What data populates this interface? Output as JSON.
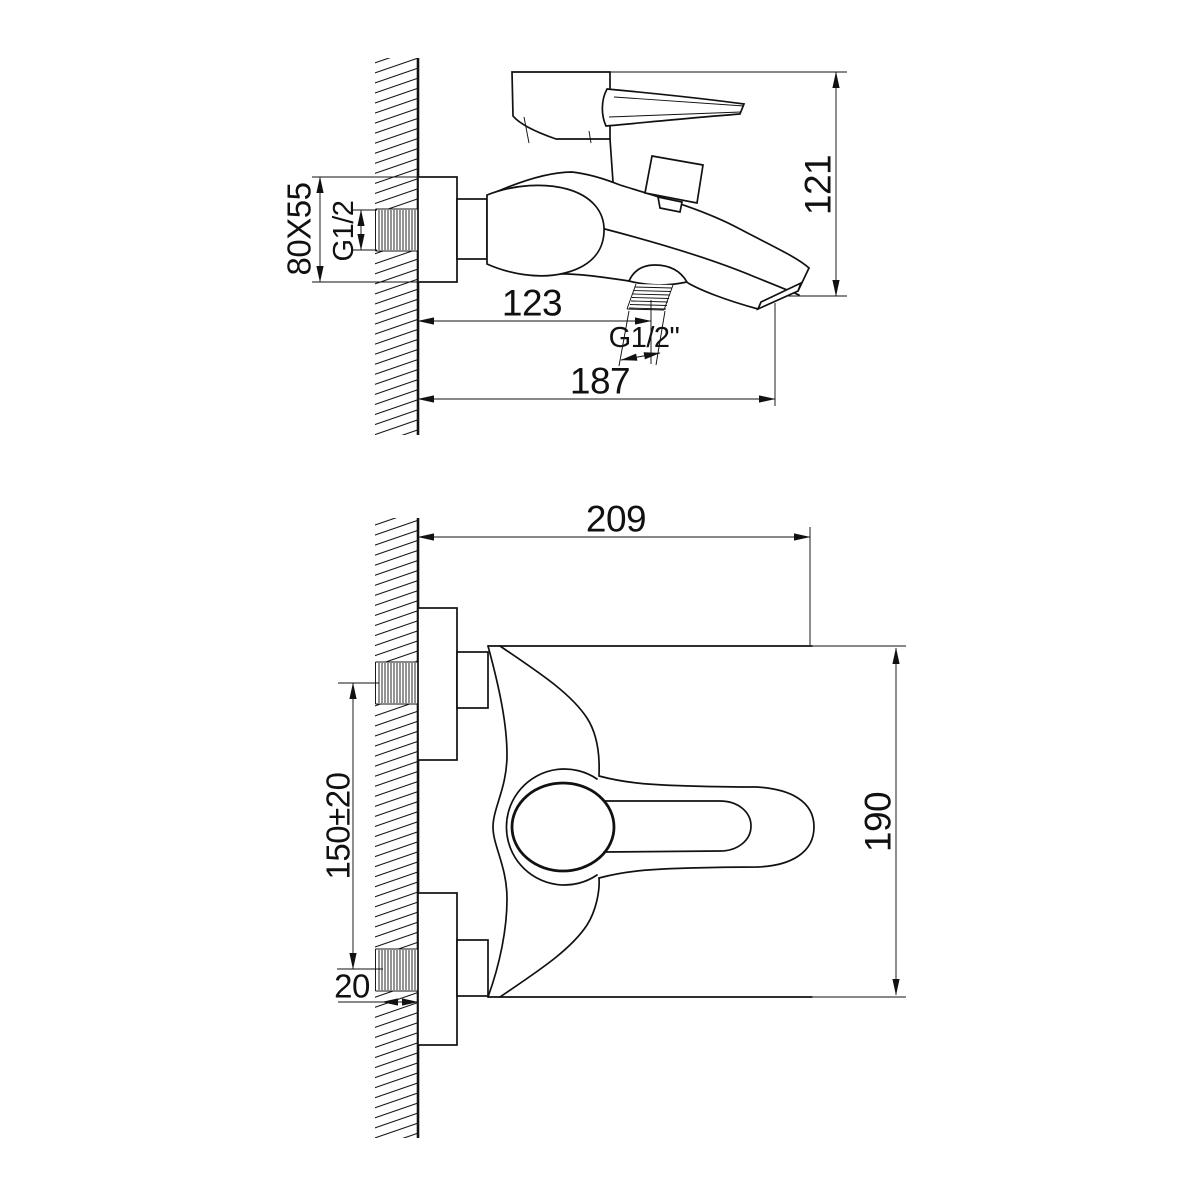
{
  "colors": {
    "line": "#111111",
    "background": "#ffffff"
  },
  "side_view": {
    "dim_flange": "80X55",
    "dim_inlet_thread": "G1/2",
    "dim_height": "121",
    "dim_shower_offset": "123",
    "dim_shower_thread": "G1/2\"",
    "dim_reach": "187"
  },
  "plan_view": {
    "dim_width": "209",
    "dim_inlet_spacing": "150±20",
    "dim_thread_length": "20",
    "dim_depth": "190"
  }
}
